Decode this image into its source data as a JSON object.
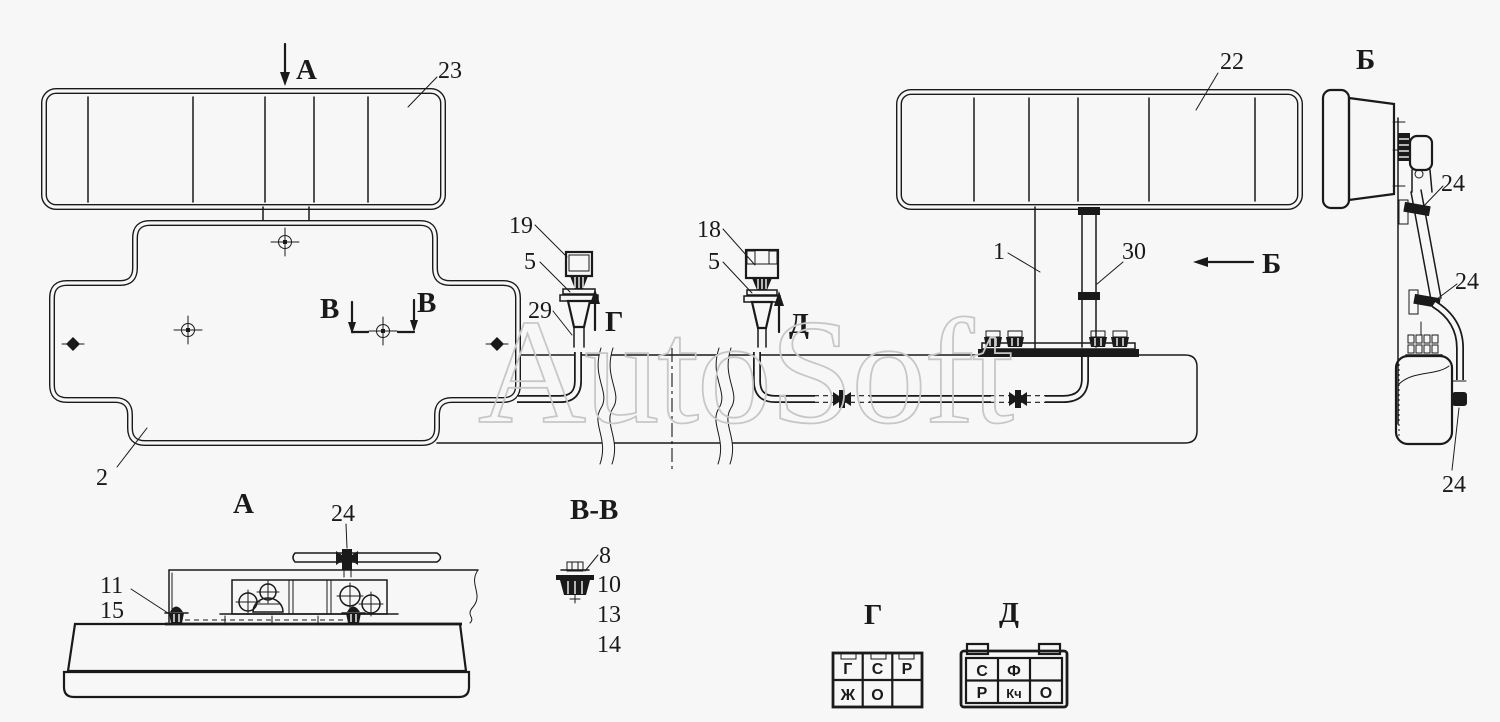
{
  "watermark": "AutoSoft",
  "colors": {
    "background": "#f7f7f7",
    "line": "#1a1a1a",
    "watermark": "#c7c7c7"
  },
  "plan": {
    "arrow_a": "А",
    "lamp_left_ref": "23",
    "bracket_ref": "2",
    "lamp_right_ref": "22",
    "post_ref": "1",
    "channel_ref": "30",
    "connector_left_ref": "19",
    "grommet_left_ref": "5",
    "boot_ref": "29",
    "connector_right_ref": "18",
    "grommet_right_ref": "5",
    "view_g_marker": "Г",
    "view_d_marker": "Д",
    "view_b_marker": "Б",
    "section_marker_left": "В",
    "section_marker_right": "В"
  },
  "view_a": {
    "title": "А",
    "clamp_ref": "24",
    "ref_11": "11",
    "ref_15": "15"
  },
  "view_b": {
    "title": "Б",
    "ref_24_upper": "24",
    "ref_24_mid": "24",
    "ref_24_lower": "24"
  },
  "section_bb": {
    "title": "В-В",
    "refs": [
      "8",
      "10",
      "13",
      "14"
    ]
  },
  "pinout_g": {
    "title": "Г",
    "row1": [
      "Г",
      "С",
      "Р"
    ],
    "row2": [
      "Ж",
      "О",
      ""
    ]
  },
  "pinout_d": {
    "title": "Д",
    "row1": [
      "С",
      "Ф",
      ""
    ],
    "row2": [
      "Р",
      "Кч",
      "О"
    ]
  }
}
